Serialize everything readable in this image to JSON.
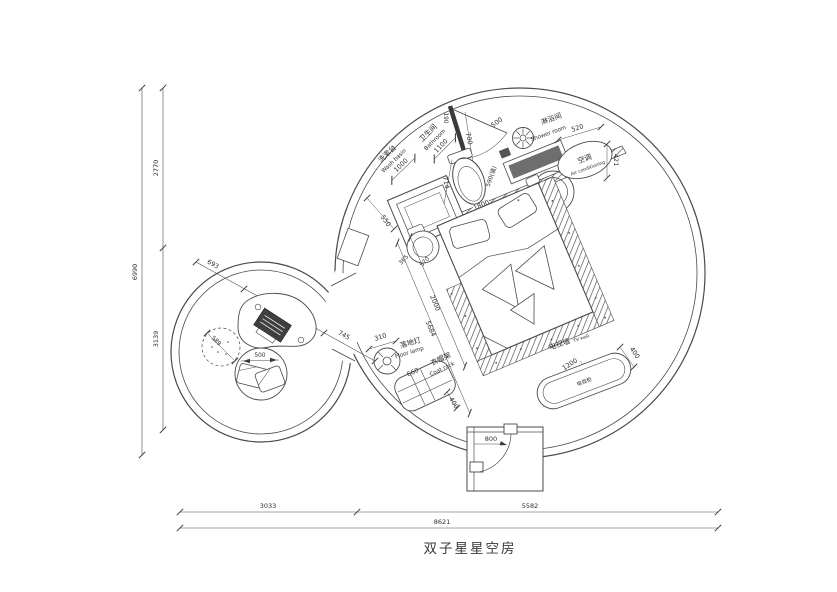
{
  "title": "双子星星空房",
  "colors": {
    "line": "#4a4a4a",
    "dark_fill": "#6e6e6e",
    "text": "#2e2e2e",
    "bg": "#ffffff"
  },
  "dimensions": {
    "left": {
      "total": "6990",
      "upper": "2770",
      "lower": "3139"
    },
    "bottom": {
      "left": "3033",
      "right": "5582",
      "total": "8621"
    }
  },
  "areas": {
    "washbasin": {
      "label_cn": "洗漱台",
      "label_en": "Wash basin",
      "width": "1000",
      "depth": "550"
    },
    "bathroom": {
      "label_cn": "卫生间",
      "label_en": "Bathroom",
      "width": "1100",
      "wall_label": "590(墙)",
      "d190": "190",
      "d700": "700",
      "d714": "714",
      "d1800": "1800",
      "d365": "365",
      "d570": "570"
    },
    "shower": {
      "label_cn": "淋浴间",
      "label_en": "Shower room",
      "door": "500"
    },
    "ac": {
      "label_cn": "空调",
      "label_en": "Air conditioning",
      "d520": "520",
      "d421": "421"
    },
    "bed": {
      "d2000": "2000",
      "d5684": "5684"
    },
    "tv": {
      "wall_cn": "电视墙",
      "wall_en": "TV wall",
      "cabinet_label": "电视柜",
      "d1200": "1200",
      "d400": "400"
    },
    "lamp": {
      "label_cn": "落地灯",
      "label_en": "Floor lamp",
      "d310": "310"
    },
    "coat_rack": {
      "d660": "660",
      "label_cn": "衣帽架",
      "label_en": "Coat rack",
      "d400": "400"
    },
    "entrance": {
      "d800": "800"
    },
    "lounge": {
      "d693": "693",
      "d1166": "1166",
      "d745": "745",
      "pouf": "589",
      "cushion": "500"
    }
  }
}
